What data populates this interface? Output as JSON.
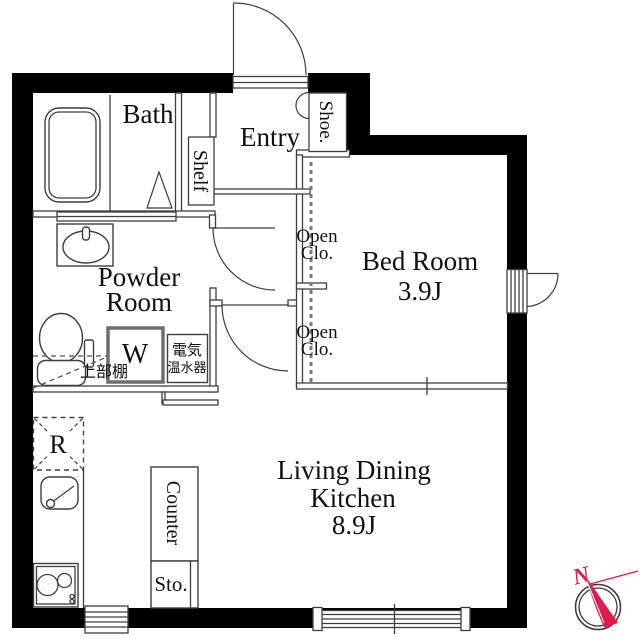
{
  "plan_title": "1K apartment floor plan",
  "rooms": {
    "bath": "Bath",
    "entry": "Entry",
    "shoe": "Shoe.",
    "shelf": "Shelf",
    "powder_line1": "Powder",
    "powder_line2": "Room",
    "bedroom_name": "Bed Room",
    "bedroom_size": "3.9J",
    "ldk_line1": "Living Dining",
    "ldk_line2": "Kitchen",
    "ldk_size": "8.9J",
    "open_clo_top_line1": "Open",
    "open_clo_top_line2": "Clo.",
    "open_clo_bottom_line1": "Open",
    "open_clo_bottom_line2": "Clo.",
    "counter": "Counter",
    "storage": "Sto.",
    "washer": "W",
    "heater_line1": "電気",
    "heater_line2": "温水器",
    "upper_shelf": "上部棚",
    "fridge": "R"
  },
  "compass": {
    "north": "N"
  },
  "colors": {
    "wall": "#000000",
    "line": "#3f3f3f",
    "accent_red": "#e31b4d",
    "background": "#ffffff",
    "text": "#111111"
  }
}
